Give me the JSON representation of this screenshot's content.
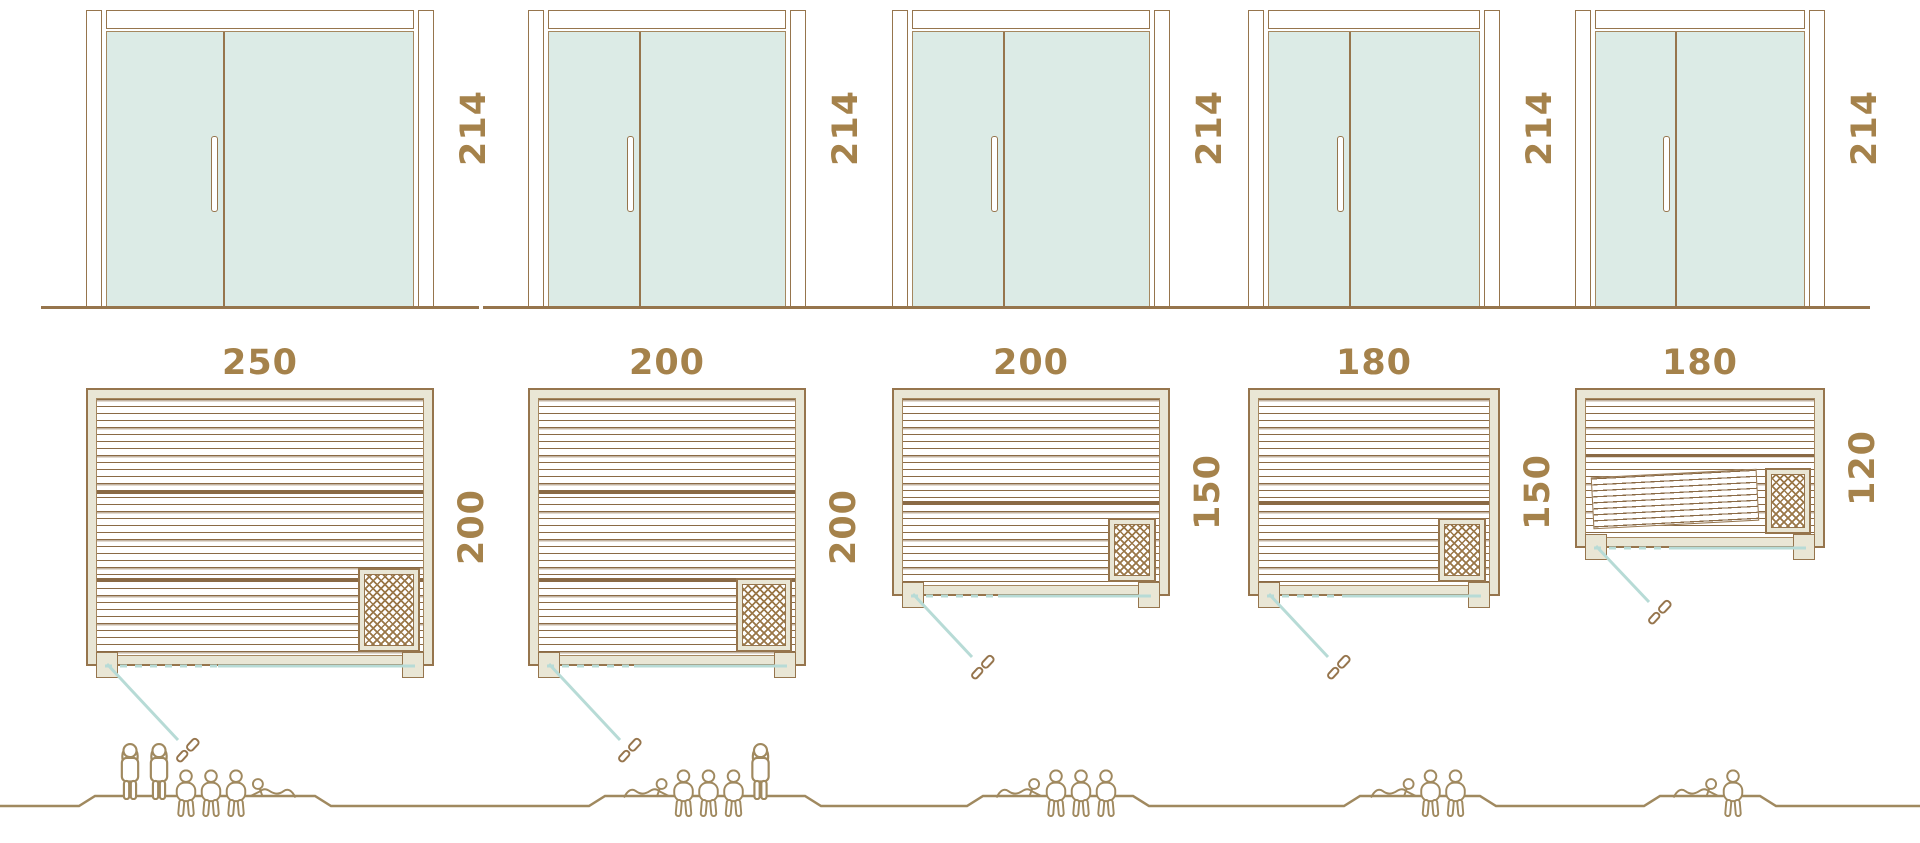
{
  "colors": {
    "outline_brown": "#96754d",
    "dimension_text": "#a5824b",
    "glass_fill": "#dcebe6",
    "frame_beige": "#e9e6d5",
    "glass_line_teal": "#b7dbd6",
    "figure_brown": "#a0895f"
  },
  "columns": [
    {
      "door_height": "214",
      "plan_width": "250",
      "plan_depth": "200",
      "capacity": 6,
      "people": [
        "standing",
        "standing",
        "seated",
        "seated",
        "seated",
        "lying"
      ]
    },
    {
      "door_height": "214",
      "plan_width": "200",
      "plan_depth": "200",
      "capacity": 5,
      "people": [
        "lying",
        "seated",
        "seated",
        "seated",
        "standing"
      ]
    },
    {
      "door_height": "214",
      "plan_width": "200",
      "plan_depth": "150",
      "capacity": 4,
      "people": [
        "lying",
        "seated",
        "seated",
        "seated"
      ]
    },
    {
      "door_height": "214",
      "plan_width": "180",
      "plan_depth": "150",
      "capacity": 3,
      "people": [
        "lying",
        "seated",
        "seated"
      ]
    },
    {
      "door_height": "214",
      "plan_width": "180",
      "plan_depth": "120",
      "capacity": 2,
      "people": [
        "lying",
        "seated"
      ]
    }
  ]
}
